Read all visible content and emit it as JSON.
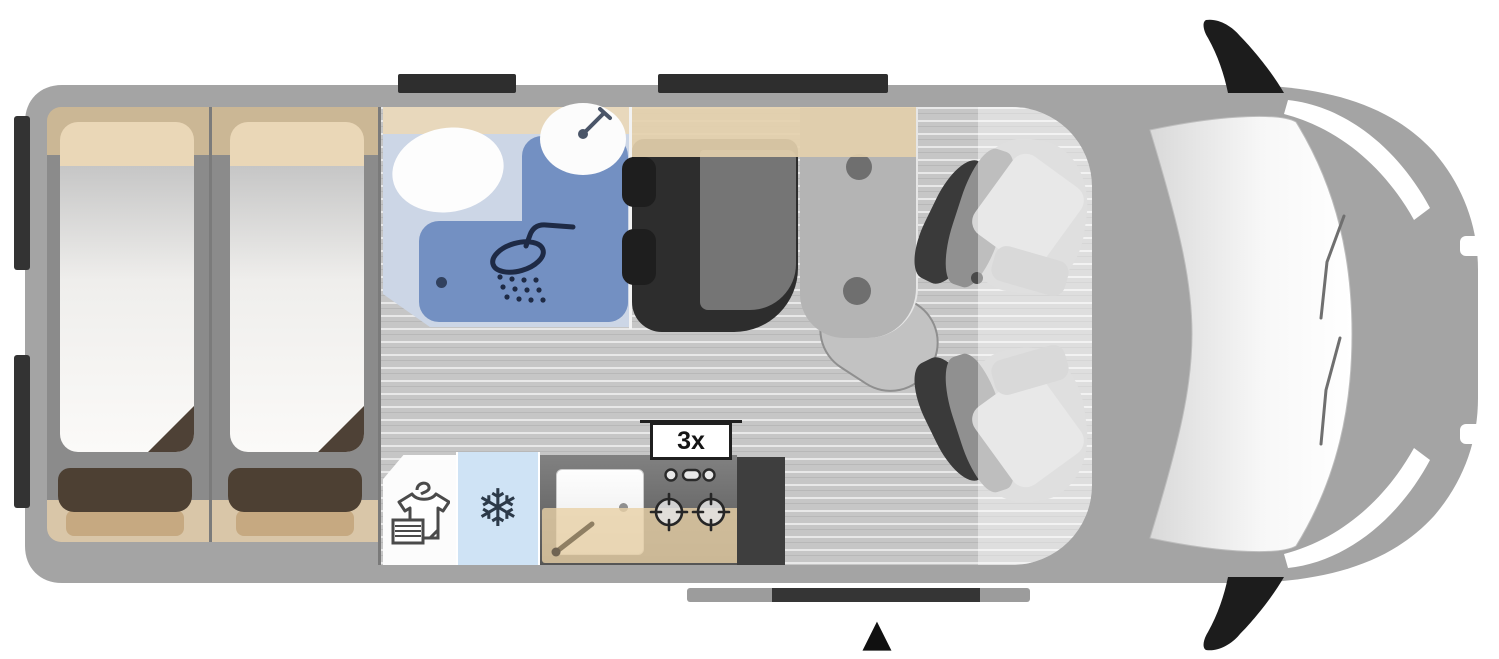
{
  "floorplan": {
    "type": "campervan-floorplan-top-view",
    "labels": {
      "burner_count": "3x"
    },
    "glyphs": {
      "snowflake": "❄",
      "entrance_arrow": "▲"
    },
    "colors": {
      "body_gray": "#a4a4a4",
      "interior_gray": "#8b8b8b",
      "floor_plank": "#c6c6c6",
      "cabinet_tan": "#cbb795",
      "counter_tan": "#e8d8bc",
      "pillow_tan": "#ead7b7",
      "mattress_white": "#fbfaf8",
      "blanket_dark_brown": "#4d4033",
      "blanket_light_brown": "#c6a981",
      "bathroom_light_blue": "#ccd6e6",
      "shower_tray_blue": "#7390c2",
      "icon_navy": "#1e2a45",
      "fridge_light_blue": "#cfe3f5",
      "kitchen_counter_gray": "#5f5f5f",
      "seat_dark": "#2d2d2d",
      "accent_black": "#1f1f1f"
    },
    "fixtures": [
      {
        "name": "single-bed-left"
      },
      {
        "name": "single-bed-right"
      },
      {
        "name": "bathroom-with-shower"
      },
      {
        "name": "wardrobe"
      },
      {
        "name": "refrigerator"
      },
      {
        "name": "kitchen-sink"
      },
      {
        "name": "two-burner-hob",
        "label": "3x"
      },
      {
        "name": "dinette-seat"
      },
      {
        "name": "table"
      },
      {
        "name": "swivel-cab-seat-upper"
      },
      {
        "name": "swivel-cab-seat-lower"
      },
      {
        "name": "sliding-door-rail"
      },
      {
        "name": "entrance-marker"
      }
    ],
    "icons": [
      {
        "name": "shower-icon"
      },
      {
        "name": "snowflake-icon"
      },
      {
        "name": "wardrobe-icon"
      },
      {
        "name": "faucet-icon"
      },
      {
        "name": "entrance-arrow-icon"
      }
    ]
  }
}
